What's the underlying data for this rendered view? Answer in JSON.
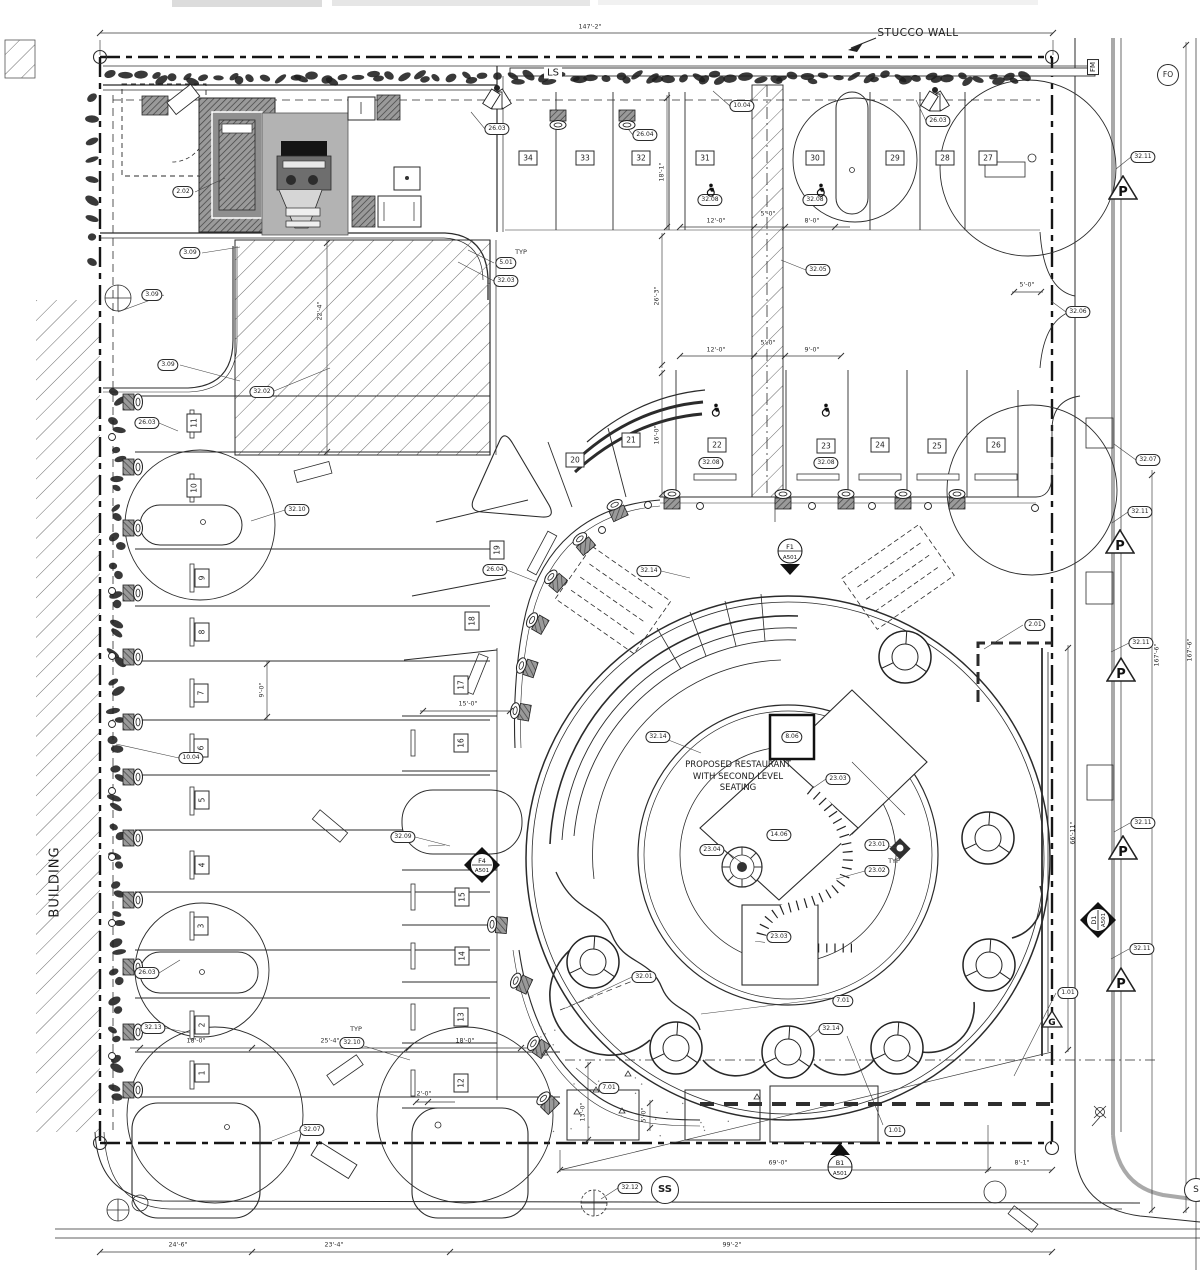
{
  "labels": {
    "building": "BUILDING",
    "stucco_wall": "STUCCO WALL",
    "landscape": "LS",
    "fm": "FM",
    "fo": "FO",
    "ss": "SS",
    "s": "S",
    "p": "P",
    "g": "G",
    "note_line1": "PROPOSED RESTAURANT",
    "note_line2": "WITH SECOND LEVEL",
    "note_line3": "SEATING"
  },
  "stalls": [
    {
      "n": "1",
      "x": 202,
      "y": 1073,
      "r": -90
    },
    {
      "n": "2",
      "x": 202,
      "y": 1025,
      "r": -90
    },
    {
      "n": "3",
      "x": 201,
      "y": 926,
      "r": -90
    },
    {
      "n": "4",
      "x": 202,
      "y": 865,
      "r": -90
    },
    {
      "n": "5",
      "x": 202,
      "y": 800,
      "r": -90
    },
    {
      "n": "6",
      "x": 201,
      "y": 748,
      "r": -90
    },
    {
      "n": "7",
      "x": 201,
      "y": 693,
      "r": -90
    },
    {
      "n": "8",
      "x": 202,
      "y": 632,
      "r": -90
    },
    {
      "n": "9",
      "x": 202,
      "y": 578,
      "r": -90
    },
    {
      "n": "10",
      "x": 194,
      "y": 488,
      "r": -90
    },
    {
      "n": "11",
      "x": 194,
      "y": 423,
      "r": -90
    },
    {
      "n": "12",
      "x": 461,
      "y": 1083,
      "r": -90
    },
    {
      "n": "13",
      "x": 461,
      "y": 1017,
      "r": -90
    },
    {
      "n": "14",
      "x": 462,
      "y": 956,
      "r": -90
    },
    {
      "n": "15",
      "x": 462,
      "y": 897,
      "r": -90
    },
    {
      "n": "16",
      "x": 461,
      "y": 743,
      "r": -90
    },
    {
      "n": "17",
      "x": 461,
      "y": 685,
      "r": -90
    },
    {
      "n": "18",
      "x": 472,
      "y": 621,
      "r": -90
    },
    {
      "n": "19",
      "x": 497,
      "y": 550,
      "r": -90
    },
    {
      "n": "20",
      "x": 575,
      "y": 460
    },
    {
      "n": "21",
      "x": 631,
      "y": 440
    },
    {
      "n": "22",
      "x": 717,
      "y": 445
    },
    {
      "n": "23",
      "x": 826,
      "y": 446
    },
    {
      "n": "24",
      "x": 880,
      "y": 445
    },
    {
      "n": "25",
      "x": 937,
      "y": 446
    },
    {
      "n": "26",
      "x": 996,
      "y": 445
    },
    {
      "n": "27",
      "x": 988,
      "y": 158
    },
    {
      "n": "28",
      "x": 945,
      "y": 158
    },
    {
      "n": "29",
      "x": 895,
      "y": 158
    },
    {
      "n": "30",
      "x": 815,
      "y": 158
    },
    {
      "n": "31",
      "x": 705,
      "y": 158
    },
    {
      "n": "32",
      "x": 641,
      "y": 158
    },
    {
      "n": "33",
      "x": 585,
      "y": 158
    },
    {
      "n": "34",
      "x": 528,
      "y": 158
    }
  ],
  "callouts": [
    {
      "t": "10.04",
      "x": 742,
      "y": 106
    },
    {
      "t": "26.03",
      "x": 497,
      "y": 129
    },
    {
      "t": "26.04",
      "x": 645,
      "y": 135
    },
    {
      "t": "26.03",
      "x": 938,
      "y": 121
    },
    {
      "t": "32.08",
      "x": 710,
      "y": 200
    },
    {
      "t": "32.08",
      "x": 815,
      "y": 200
    },
    {
      "t": "32.11",
      "x": 1143,
      "y": 157
    },
    {
      "t": "32.06",
      "x": 1078,
      "y": 312
    },
    {
      "t": "2.02",
      "x": 183,
      "y": 192
    },
    {
      "t": "3.09",
      "x": 190,
      "y": 253
    },
    {
      "t": "3.09",
      "x": 152,
      "y": 295
    },
    {
      "t": "3.09",
      "x": 168,
      "y": 365
    },
    {
      "t": "32.02",
      "x": 262,
      "y": 392
    },
    {
      "t": "5.01",
      "x": 506,
      "y": 263
    },
    {
      "t": "32.03",
      "x": 506,
      "y": 281
    },
    {
      "t": "32.05",
      "x": 818,
      "y": 270
    },
    {
      "t": "26.03",
      "x": 147,
      "y": 423
    },
    {
      "t": "32.10",
      "x": 297,
      "y": 510
    },
    {
      "t": "32.08",
      "x": 711,
      "y": 463
    },
    {
      "t": "32.08",
      "x": 826,
      "y": 463
    },
    {
      "t": "32.07",
      "x": 1148,
      "y": 460
    },
    {
      "t": "26.04",
      "x": 495,
      "y": 570
    },
    {
      "t": "32.14",
      "x": 649,
      "y": 571
    },
    {
      "t": "32.11",
      "x": 1140,
      "y": 512
    },
    {
      "t": "2.01",
      "x": 1035,
      "y": 625
    },
    {
      "t": "32.11",
      "x": 1141,
      "y": 643
    },
    {
      "t": "10.04",
      "x": 191,
      "y": 758
    },
    {
      "t": "32.14",
      "x": 658,
      "y": 737
    },
    {
      "t": "8.06",
      "x": 792,
      "y": 737
    },
    {
      "t": "23.03",
      "x": 838,
      "y": 779
    },
    {
      "t": "14.06",
      "x": 779,
      "y": 835
    },
    {
      "t": "23.04",
      "x": 712,
      "y": 850
    },
    {
      "t": "23.01",
      "x": 877,
      "y": 845
    },
    {
      "t": "23.02",
      "x": 877,
      "y": 871
    },
    {
      "t": "32.09",
      "x": 403,
      "y": 837
    },
    {
      "t": "32.11",
      "x": 1143,
      "y": 823
    },
    {
      "t": "26.03",
      "x": 147,
      "y": 973
    },
    {
      "t": "23.03",
      "x": 779,
      "y": 937
    },
    {
      "t": "32.01",
      "x": 644,
      "y": 977
    },
    {
      "t": "32.13",
      "x": 153,
      "y": 1028
    },
    {
      "t": "32.10",
      "x": 352,
      "y": 1043
    },
    {
      "t": "7.01",
      "x": 843,
      "y": 1001
    },
    {
      "t": "32.14",
      "x": 831,
      "y": 1029
    },
    {
      "t": "32.11",
      "x": 1142,
      "y": 949
    },
    {
      "t": "1.01",
      "x": 1068,
      "y": 993
    },
    {
      "t": "7.01",
      "x": 609,
      "y": 1088
    },
    {
      "t": "1.01",
      "x": 895,
      "y": 1131
    },
    {
      "t": "32.07",
      "x": 312,
      "y": 1130
    },
    {
      "t": "32.12",
      "x": 630,
      "y": 1188
    }
  ],
  "dims": [
    {
      "t": "147'-2\"",
      "x": 590,
      "y": 27
    },
    {
      "t": "12'-0\"",
      "x": 716,
      "y": 221
    },
    {
      "t": "5'-0\"",
      "x": 768,
      "y": 214
    },
    {
      "t": "8'-0\"",
      "x": 812,
      "y": 221
    },
    {
      "t": "18'-1\"",
      "x": 662,
      "y": 172,
      "r": -90
    },
    {
      "t": "5'-0\"",
      "x": 1027,
      "y": 285
    },
    {
      "t": "22'-4\"",
      "x": 320,
      "y": 311,
      "r": -90
    },
    {
      "t": "26'-3\"",
      "x": 657,
      "y": 296,
      "r": -90
    },
    {
      "t": "12'-0\"",
      "x": 716,
      "y": 350
    },
    {
      "t": "5'-0\"",
      "x": 768,
      "y": 343
    },
    {
      "t": "9'-0\"",
      "x": 812,
      "y": 350
    },
    {
      "t": "16'-0\"",
      "x": 657,
      "y": 435,
      "r": -90
    },
    {
      "t": "9'-0\"",
      "x": 262,
      "y": 690,
      "r": -90
    },
    {
      "t": "15'-0\"",
      "x": 468,
      "y": 704
    },
    {
      "t": "167'-6\"",
      "x": 1157,
      "y": 655,
      "r": -90
    },
    {
      "t": "167'-6\"",
      "x": 1190,
      "y": 650,
      "r": -90
    },
    {
      "t": "66'-11\"",
      "x": 1073,
      "y": 833,
      "r": -90
    },
    {
      "t": "18'-0\"",
      "x": 196,
      "y": 1041
    },
    {
      "t": "25'-4\"",
      "x": 330,
      "y": 1041
    },
    {
      "t": "18'-0\"",
      "x": 465,
      "y": 1041
    },
    {
      "t": "2'-0\"",
      "x": 424,
      "y": 1094
    },
    {
      "t": "13'-0\"",
      "x": 583,
      "y": 1112,
      "r": -90
    },
    {
      "t": "5'-0\"",
      "x": 644,
      "y": 1115,
      "r": -90
    },
    {
      "t": "69'-0\"",
      "x": 778,
      "y": 1163
    },
    {
      "t": "8'-1\"",
      "x": 1022,
      "y": 1163
    },
    {
      "t": "24'-6\"",
      "x": 178,
      "y": 1245
    },
    {
      "t": "23'-4\"",
      "x": 334,
      "y": 1245
    },
    {
      "t": "99'-2\"",
      "x": 732,
      "y": 1245
    }
  ],
  "texts": [
    {
      "t": "TYP",
      "x": 521,
      "y": 252
    },
    {
      "t": "TYP",
      "x": 894,
      "y": 861
    },
    {
      "t": "TYP",
      "x": 356,
      "y": 1029
    }
  ],
  "p_signs": [
    {
      "x": 1108,
      "y": 175
    },
    {
      "x": 1105,
      "y": 529
    },
    {
      "x": 1106,
      "y": 657
    },
    {
      "x": 1108,
      "y": 835
    },
    {
      "x": 1106,
      "y": 967
    }
  ],
  "g_sign": {
    "x": 1041,
    "y": 1010
  },
  "section_markers": [
    {
      "top": "F1",
      "bottom": "A501",
      "x": 775,
      "y": 537,
      "shape": "circle-down"
    },
    {
      "top": "F4",
      "bottom": "A501",
      "x": 462,
      "y": 845,
      "shape": "diamond"
    },
    {
      "top": "D1",
      "bottom": "A501",
      "x": 1078,
      "y": 900,
      "shape": "diamond",
      "rot": -90
    },
    {
      "top": "B1",
      "bottom": "A501",
      "x": 825,
      "y": 1141,
      "shape": "circle-up"
    }
  ],
  "accessible_stalls": [
    {
      "x": 705,
      "y": 183
    },
    {
      "x": 815,
      "y": 183
    },
    {
      "x": 710,
      "y": 403
    },
    {
      "x": 820,
      "y": 403
    }
  ]
}
